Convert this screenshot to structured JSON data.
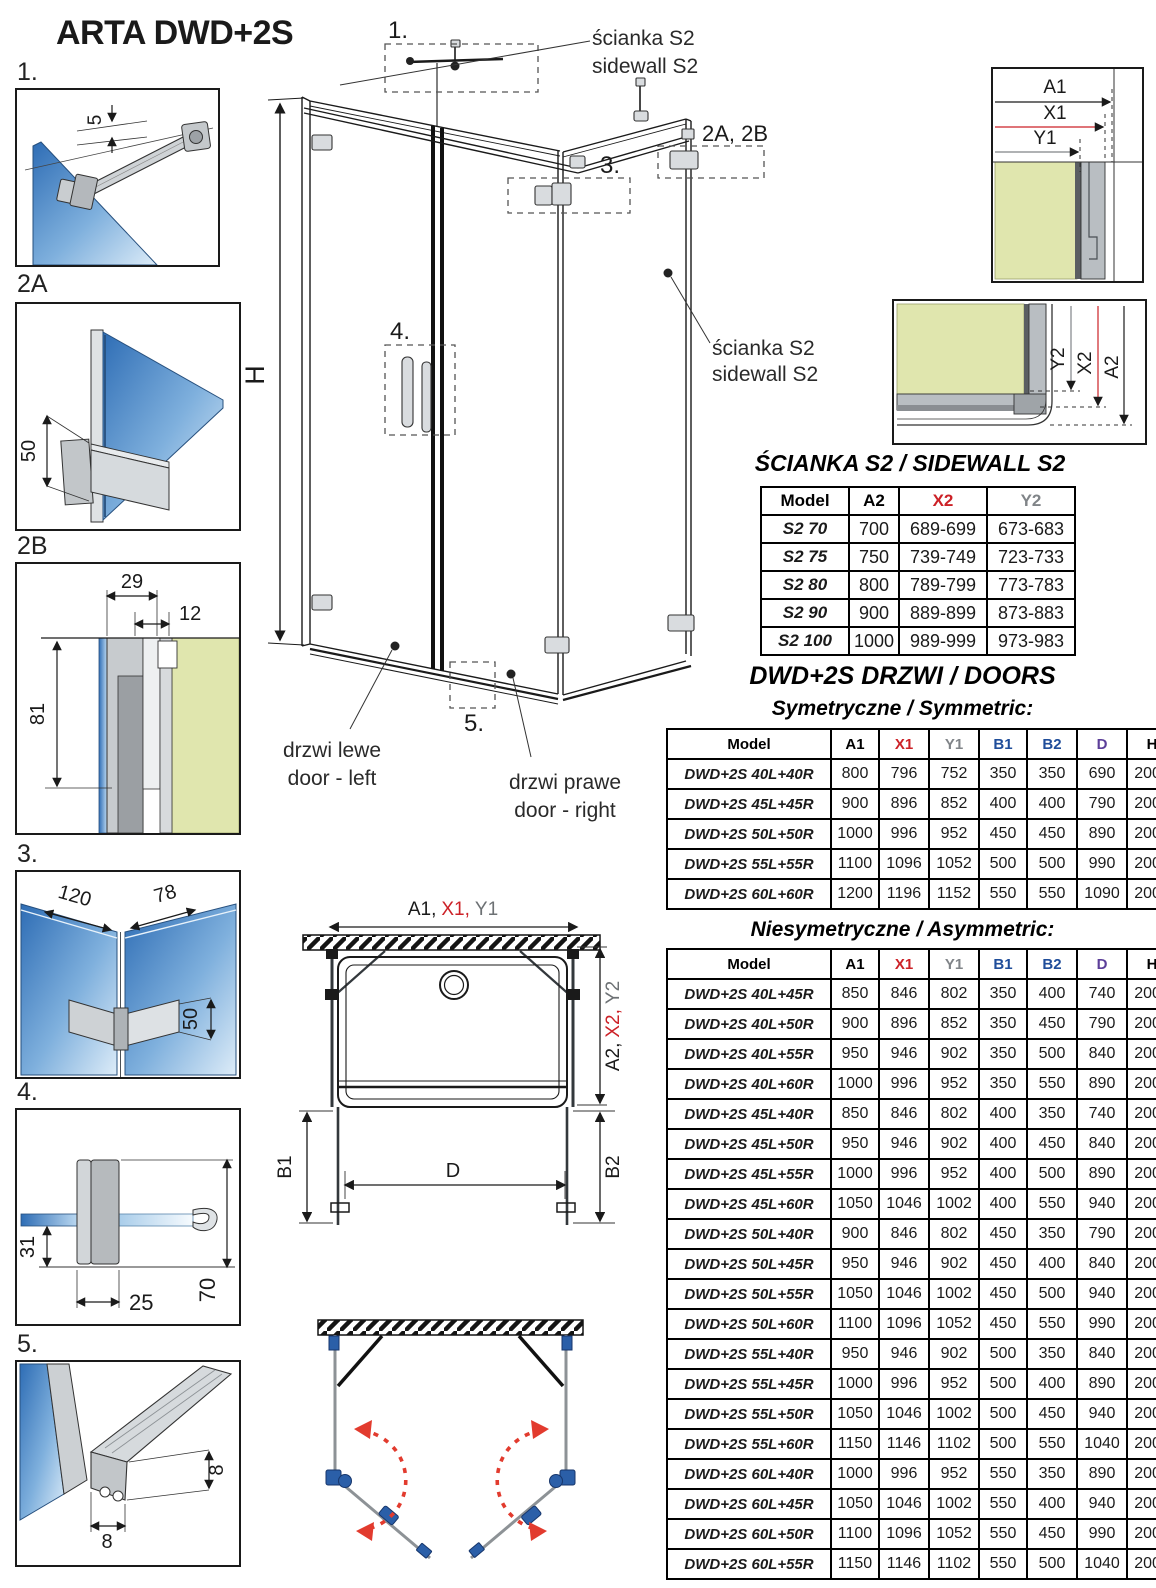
{
  "title": "ARTA DWD+2S",
  "colors": {
    "red": "#cc2127",
    "gray": "#808488",
    "blue": "#1f4d9a",
    "purple": "#5c3f99",
    "green_wall": "#e0e6ae",
    "glass_blue": "#2e6db5",
    "swing_red": "#e23b2e",
    "hardware_blue": "#2b5fa8"
  },
  "details": {
    "d1": {
      "label": "1.",
      "dim_gap": "5"
    },
    "d2a": {
      "label": "2A",
      "dim_height": "50"
    },
    "d2b": {
      "label": "2B",
      "dim_a": "29",
      "dim_b": "12",
      "dim_c": "81"
    },
    "d3": {
      "label": "3.",
      "dim_a": "120",
      "dim_b": "78",
      "dim_c": "50"
    },
    "d4": {
      "label": "4.",
      "dim_a": "31",
      "dim_b": "25",
      "dim_c": "70"
    },
    "d5": {
      "label": "5.",
      "dim_a": "8",
      "dim_b": "8"
    }
  },
  "main": {
    "callout1": "1.",
    "callout2ab": "2A, 2B",
    "callout3": "3.",
    "callout4": "4.",
    "callout5": "5.",
    "height": "H",
    "sidewall_line1": "ścianka S2",
    "sidewall_line2": "sidewall S2",
    "door_left_pl": "drzwi lewe",
    "door_left_en": "door - left",
    "door_right_pl": "drzwi prawe",
    "door_right_en": "door - right"
  },
  "corner_top": {
    "a1": "A1",
    "x1": "X1",
    "y1": "Y1"
  },
  "corner_side": {
    "y2": "Y2",
    "x2": "X2",
    "a2": "A2"
  },
  "plan": {
    "a1": "A1,",
    "x1": "X1,",
    "y1": "Y1",
    "a2": "A2,",
    "x2": "X2,",
    "y2": "Y2",
    "b1": "B1",
    "b2": "B2",
    "d": "D"
  },
  "sidewall_table": {
    "heading": "ŚCIANKA S2 / SIDEWALL S2",
    "columns": [
      "Model",
      "A2",
      "X2",
      "Y2"
    ],
    "header_colors": [
      "#000000",
      "#000000",
      "#cc2127",
      "#808488"
    ],
    "rows": [
      [
        "S2 70",
        "700",
        "689-699",
        "673-683"
      ],
      [
        "S2 75",
        "750",
        "739-749",
        "723-733"
      ],
      [
        "S2 80",
        "800",
        "789-799",
        "773-783"
      ],
      [
        "S2 90",
        "900",
        "889-899",
        "873-883"
      ],
      [
        "S2 100",
        "1000",
        "989-999",
        "973-983"
      ]
    ]
  },
  "doors": {
    "heading": "DWD+2S DRZWI / DOORS",
    "symmetric_heading": "Symetryczne / Symmetric:",
    "asymmetric_heading": "Niesymetryczne / Asymmetric:"
  },
  "symmetric_table": {
    "columns": [
      "Model",
      "A1",
      "X1",
      "Y1",
      "B1",
      "B2",
      "D",
      "H"
    ],
    "header_colors": [
      "#000000",
      "#000000",
      "#cc2127",
      "#808488",
      "#1f4d9a",
      "#1f4d9a",
      "#5c3f99",
      "#000000"
    ],
    "rows": [
      [
        "DWD+2S 40L+40R",
        "800",
        "796",
        "752",
        "350",
        "350",
        "690",
        "2000"
      ],
      [
        "DWD+2S 45L+45R",
        "900",
        "896",
        "852",
        "400",
        "400",
        "790",
        "2000"
      ],
      [
        "DWD+2S 50L+50R",
        "1000",
        "996",
        "952",
        "450",
        "450",
        "890",
        "2000"
      ],
      [
        "DWD+2S 55L+55R",
        "1100",
        "1096",
        "1052",
        "500",
        "500",
        "990",
        "2000"
      ],
      [
        "DWD+2S 60L+60R",
        "1200",
        "1196",
        "1152",
        "550",
        "550",
        "1090",
        "2000"
      ]
    ]
  },
  "asymmetric_table": {
    "columns": [
      "Model",
      "A1",
      "X1",
      "Y1",
      "B1",
      "B2",
      "D",
      "H"
    ],
    "header_colors": [
      "#000000",
      "#000000",
      "#cc2127",
      "#808488",
      "#1f4d9a",
      "#1f4d9a",
      "#5c3f99",
      "#000000"
    ],
    "rows": [
      [
        "DWD+2S 40L+45R",
        "850",
        "846",
        "802",
        "350",
        "400",
        "740",
        "2000"
      ],
      [
        "DWD+2S 40L+50R",
        "900",
        "896",
        "852",
        "350",
        "450",
        "790",
        "2000"
      ],
      [
        "DWD+2S 40L+55R",
        "950",
        "946",
        "902",
        "350",
        "500",
        "840",
        "2000"
      ],
      [
        "DWD+2S 40L+60R",
        "1000",
        "996",
        "952",
        "350",
        "550",
        "890",
        "2000"
      ],
      [
        "DWD+2S 45L+40R",
        "850",
        "846",
        "802",
        "400",
        "350",
        "740",
        "2000"
      ],
      [
        "DWD+2S 45L+50R",
        "950",
        "946",
        "902",
        "400",
        "450",
        "840",
        "2000"
      ],
      [
        "DWD+2S 45L+55R",
        "1000",
        "996",
        "952",
        "400",
        "500",
        "890",
        "2000"
      ],
      [
        "DWD+2S 45L+60R",
        "1050",
        "1046",
        "1002",
        "400",
        "550",
        "940",
        "2000"
      ],
      [
        "DWD+2S 50L+40R",
        "900",
        "846",
        "802",
        "450",
        "350",
        "790",
        "2000"
      ],
      [
        "DWD+2S 50L+45R",
        "950",
        "946",
        "902",
        "450",
        "400",
        "840",
        "2000"
      ],
      [
        "DWD+2S 50L+55R",
        "1050",
        "1046",
        "1002",
        "450",
        "500",
        "940",
        "2000"
      ],
      [
        "DWD+2S 50L+60R",
        "1100",
        "1096",
        "1052",
        "450",
        "550",
        "990",
        "2000"
      ],
      [
        "DWD+2S 55L+40R",
        "950",
        "946",
        "902",
        "500",
        "350",
        "840",
        "2000"
      ],
      [
        "DWD+2S 55L+45R",
        "1000",
        "996",
        "952",
        "500",
        "400",
        "890",
        "2000"
      ],
      [
        "DWD+2S 55L+50R",
        "1050",
        "1046",
        "1002",
        "500",
        "450",
        "940",
        "2000"
      ],
      [
        "DWD+2S 55L+60R",
        "1150",
        "1146",
        "1102",
        "500",
        "550",
        "1040",
        "2000"
      ],
      [
        "DWD+2S 60L+40R",
        "1000",
        "996",
        "952",
        "550",
        "350",
        "890",
        "2000"
      ],
      [
        "DWD+2S 60L+45R",
        "1050",
        "1046",
        "1002",
        "550",
        "400",
        "940",
        "2000"
      ],
      [
        "DWD+2S 60L+50R",
        "1100",
        "1096",
        "1052",
        "550",
        "450",
        "990",
        "2000"
      ],
      [
        "DWD+2S 60L+55R",
        "1150",
        "1146",
        "1102",
        "550",
        "500",
        "1040",
        "2000"
      ]
    ]
  }
}
